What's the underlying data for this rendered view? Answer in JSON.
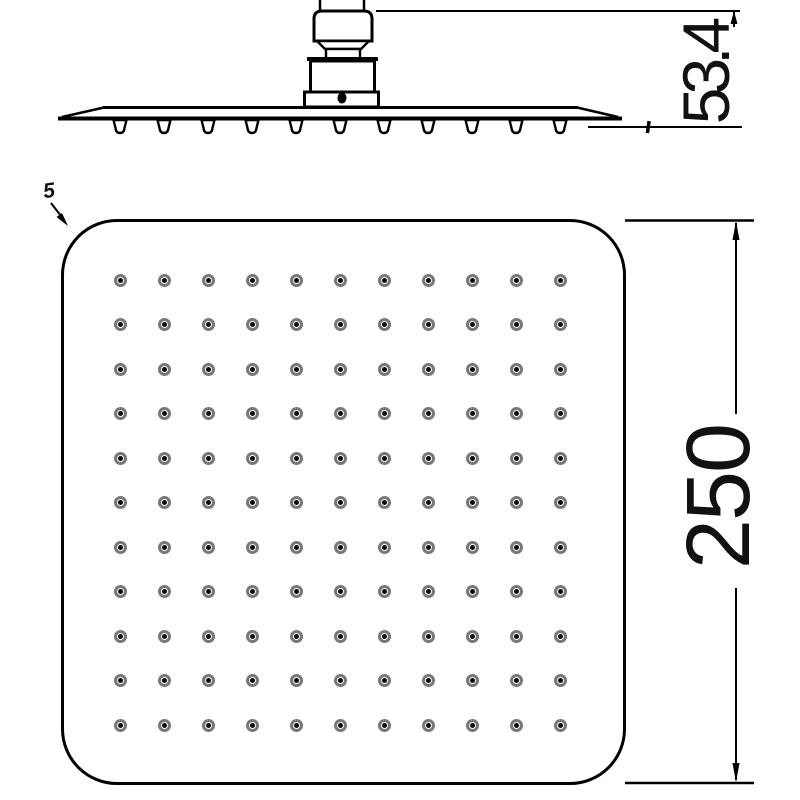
{
  "drawing": {
    "side_view": {
      "name": "side elevation",
      "height_label": "53.4",
      "nozzle_teeth_count": 11
    },
    "face_view": {
      "name": "spray face view",
      "size_label": "250",
      "corner_label": "5",
      "grid": {
        "rows": 11,
        "cols": 11,
        "total_nozzles": 121
      }
    },
    "colors": {
      "line": "#000000",
      "nozzle_ring": "#787878",
      "background": "#ffffff"
    }
  }
}
